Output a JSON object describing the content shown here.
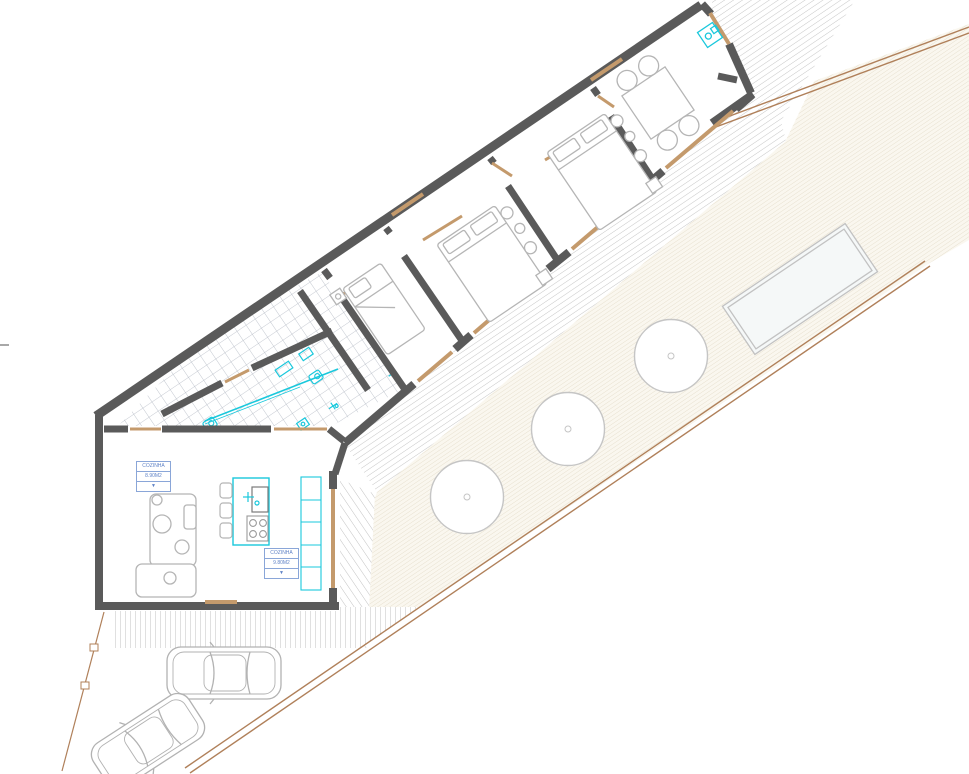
{
  "title": "house-floor-plan",
  "colors": {
    "wall": "#5a5a5a",
    "window_tan": "#c49a6c",
    "boundary_tan": "#b0805a",
    "fixture_cyan": "#1ac8dc",
    "furniture_gray": "#b5b5b5",
    "label_blue": "#5f82c6",
    "deck_line": "#c6c6c6",
    "yard_fill": "#faf7ef",
    "yard_line": "#e3dbc8",
    "tile_line": "#b3b9c4"
  },
  "labels": [
    {
      "line1": "COZINHA",
      "line2": "8.90M2",
      "line3": "▼"
    },
    {
      "line1": "COZINHA",
      "line2": "9.80M2",
      "line3": "▼"
    }
  ],
  "site": {
    "trees": [
      {
        "transform": "translate(467,497)"
      },
      {
        "transform": "translate(568,429)"
      },
      {
        "transform": "translate(671,356)"
      }
    ],
    "pool": {
      "transform": "translate(800,289) rotate(-34)"
    },
    "cars": [
      {
        "transform": "translate(224,673)"
      },
      {
        "transform": "translate(148,741) rotate(-33)"
      }
    ],
    "appliance": {
      "transform": "translate(710,35) rotate(-34)"
    },
    "dining": {
      "transform": "translate(658,103) rotate(-34)"
    },
    "beds": [
      {
        "transform": "translate(384,309) rotate(-34)",
        "type": "single"
      },
      {
        "transform": "translate(492,264) rotate(-34)",
        "type": "double"
      },
      {
        "transform": "translate(602,172) rotate(-34)",
        "type": "double"
      }
    ]
  }
}
